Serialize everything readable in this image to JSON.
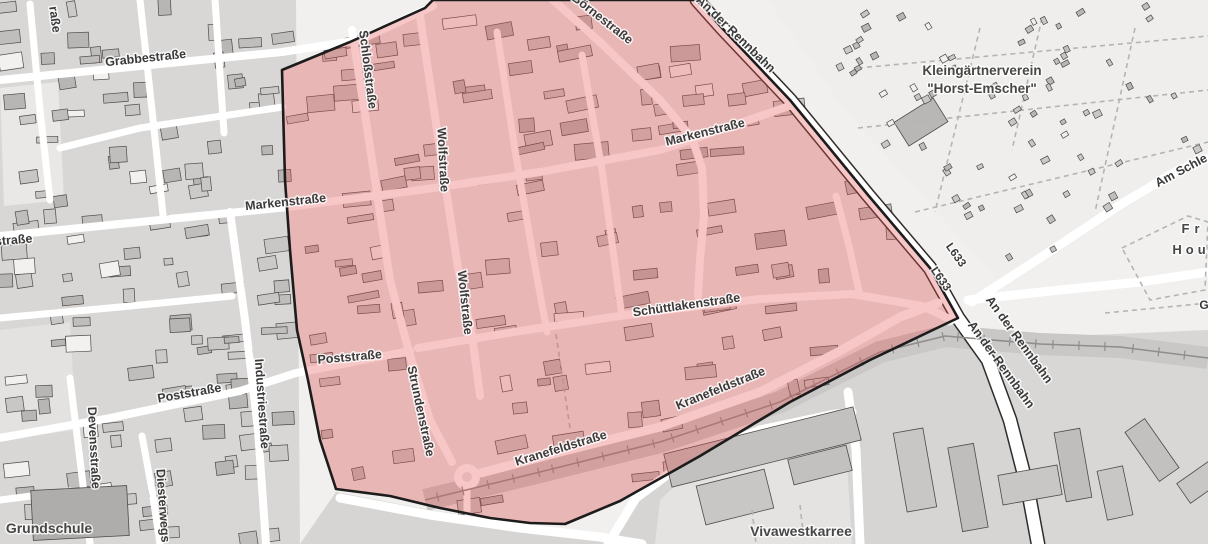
{
  "map": {
    "colors": {
      "background": "#f1f0ee",
      "block_gray": "#d8d7d5",
      "block_light": "#e9e8e6",
      "kgv_bg": "#efeeec",
      "street_white": "#ffffff",
      "building_outline": "#4e4a48",
      "main_road_casing": "#2e2d2c",
      "railway": "#8e8d8b",
      "railway_corridor": "#c9c8c6",
      "label_street": "#3a3a3a",
      "label_area": "#474747",
      "highlight_fill": "rgba(230,78,78,0.32)",
      "highlight_border": "#1c1c1c"
    },
    "highlight_area": {
      "points": [
        [
          282,
          70
        ],
        [
          350,
          42
        ],
        [
          425,
          8
        ],
        [
          433,
          0
        ],
        [
          697,
          0
        ],
        [
          722,
          28
        ],
        [
          790,
          100
        ],
        [
          868,
          195
        ],
        [
          930,
          268
        ],
        [
          958,
          318
        ],
        [
          870,
          360
        ],
        [
          790,
          402
        ],
        [
          700,
          456
        ],
        [
          620,
          501
        ],
        [
          565,
          524
        ],
        [
          530,
          523
        ],
        [
          490,
          518
        ],
        [
          440,
          508
        ],
        [
          390,
          496
        ],
        [
          336,
          489
        ],
        [
          320,
          440
        ],
        [
          308,
          380
        ],
        [
          297,
          330
        ],
        [
          290,
          250
        ],
        [
          285,
          180
        ]
      ]
    },
    "railway": {
      "points": [
        [
          425,
          500
        ],
        [
          540,
          472
        ],
        [
          660,
          442
        ],
        [
          780,
          402
        ],
        [
          880,
          352
        ],
        [
          945,
          336
        ],
        [
          1040,
          344
        ],
        [
          1120,
          347
        ],
        [
          1208,
          358
        ]
      ]
    },
    "roads": [
      {
        "name": "Grabbestraße",
        "width": 8,
        "points": [
          [
            0,
            80
          ],
          [
            140,
            66
          ],
          [
            282,
            52
          ],
          [
            360,
            40
          ],
          [
            433,
            6
          ]
        ]
      },
      {
        "name": "Börnestraße",
        "width": 8,
        "points": [
          [
            553,
            0
          ],
          [
            600,
            42
          ],
          [
            660,
            100
          ],
          [
            692,
            138
          ],
          [
            702,
            168
          ],
          [
            704,
            215
          ],
          [
            700,
            260
          ],
          [
            698,
            296
          ]
        ]
      },
      {
        "name": "Markenstraße",
        "width": 8,
        "points": [
          [
            0,
            236
          ],
          [
            140,
            222
          ],
          [
            288,
            207
          ],
          [
            420,
            190
          ],
          [
            540,
            172
          ],
          [
            660,
            150
          ],
          [
            694,
            139
          ],
          [
            795,
            104
          ]
        ]
      },
      {
        "name": "Schüttlakenstraße",
        "width": 8,
        "points": [
          [
            418,
            348
          ],
          [
            520,
            331
          ],
          [
            633,
            314
          ],
          [
            760,
            299
          ],
          [
            852,
            294
          ],
          [
            922,
            306
          ],
          [
            952,
            320
          ]
        ]
      },
      {
        "name": "Poststraße",
        "width": 8,
        "points": [
          [
            0,
            438
          ],
          [
            110,
            418
          ],
          [
            240,
            391
          ],
          [
            296,
            373
          ],
          [
            410,
            351
          ]
        ]
      },
      {
        "name": "Schloßstraße-Strundenstraße",
        "width": 8,
        "points": [
          [
            352,
            30
          ],
          [
            372,
            160
          ],
          [
            390,
            280
          ],
          [
            409,
            352
          ],
          [
            430,
            420
          ],
          [
            452,
            462
          ]
        ]
      },
      {
        "name": "Wolfstraße",
        "width": 8,
        "points": [
          [
            420,
            16
          ],
          [
            440,
            150
          ],
          [
            458,
            268
          ],
          [
            472,
            335
          ],
          [
            480,
            396
          ]
        ]
      },
      {
        "name": "",
        "width": 7,
        "points": [
          [
            497,
            32
          ],
          [
            515,
            150
          ],
          [
            532,
            250
          ],
          [
            547,
            332
          ]
        ]
      },
      {
        "name": "",
        "width": 7,
        "points": [
          [
            582,
            55
          ],
          [
            602,
            170
          ],
          [
            615,
            265
          ],
          [
            621,
            310
          ]
        ]
      },
      {
        "name": "",
        "width": 7,
        "points": [
          [
            836,
            196
          ],
          [
            850,
            250
          ],
          [
            860,
            296
          ]
        ]
      },
      {
        "name": "Kranefeldstraße",
        "width": 9,
        "points": [
          [
            481,
            473
          ],
          [
            560,
            452
          ],
          [
            660,
            427
          ],
          [
            760,
            392
          ],
          [
            840,
            351
          ],
          [
            900,
            317
          ],
          [
            938,
            303
          ]
        ]
      },
      {
        "name": "An der Rennbahn / L633",
        "width": 12,
        "casing": true,
        "points": [
          [
            697,
            0
          ],
          [
            722,
            28
          ],
          [
            790,
            100
          ],
          [
            868,
            195
          ],
          [
            930,
            268
          ],
          [
            958,
            318
          ],
          [
            988,
            360
          ],
          [
            1010,
            420
          ],
          [
            1028,
            490
          ],
          [
            1038,
            544
          ]
        ]
      },
      {
        "name": "Am Schle…",
        "width": 9,
        "points": [
          [
            972,
            302
          ],
          [
            1040,
            258
          ],
          [
            1120,
            205
          ],
          [
            1175,
            172
          ],
          [
            1208,
            158
          ]
        ]
      },
      {
        "name": "",
        "width": 9,
        "points": [
          [
            968,
            300
          ],
          [
            1060,
            290
          ],
          [
            1140,
            282
          ],
          [
            1208,
            272
          ]
        ]
      },
      {
        "name": "",
        "width": 9,
        "points": [
          [
            848,
            392
          ],
          [
            856,
            450
          ],
          [
            860,
            544
          ]
        ]
      },
      {
        "name": "",
        "width": 9,
        "points": [
          [
            608,
            544
          ],
          [
            636,
            498
          ],
          [
            690,
            458
          ],
          [
            760,
            430
          ],
          [
            830,
            415
          ],
          [
            852,
            412
          ]
        ]
      },
      {
        "name": "",
        "width": 9,
        "points": [
          [
            340,
            498
          ],
          [
            430,
            515
          ],
          [
            520,
            528
          ],
          [
            600,
            537
          ],
          [
            642,
            544
          ]
        ]
      },
      {
        "name": "Devensstraße",
        "width": 7,
        "points": [
          [
            70,
            378
          ],
          [
            80,
            460
          ],
          [
            90,
            544
          ]
        ]
      },
      {
        "name": "Industriestraße",
        "width": 8,
        "points": [
          [
            230,
            212
          ],
          [
            245,
            320
          ],
          [
            258,
            430
          ],
          [
            266,
            544
          ]
        ]
      },
      {
        "name": "Diesterwegstraße",
        "width": 7,
        "points": [
          [
            142,
            436
          ],
          [
            152,
            490
          ],
          [
            160,
            544
          ]
        ]
      },
      {
        "name": "teweg",
        "width": 7,
        "points": [
          [
            0,
            500
          ],
          [
            70,
            491
          ]
        ]
      },
      {
        "name": "",
        "width": 7,
        "points": [
          [
            0,
            318
          ],
          [
            120,
            307
          ],
          [
            232,
            296
          ]
        ]
      },
      {
        "name": "",
        "width": 7,
        "points": [
          [
            60,
            148
          ],
          [
            140,
            128
          ],
          [
            283,
            107
          ]
        ]
      },
      {
        "name": "",
        "width": 7,
        "points": [
          [
            30,
            4
          ],
          [
            40,
            110
          ],
          [
            50,
            200
          ]
        ]
      },
      {
        "name": "",
        "width": 7,
        "points": [
          [
            140,
            0
          ],
          [
            152,
            110
          ],
          [
            163,
            215
          ]
        ]
      },
      {
        "name": "",
        "width": 7,
        "points": [
          [
            215,
            0
          ],
          [
            224,
            133
          ]
        ]
      },
      {
        "name": "",
        "width": 7,
        "points": [
          [
            467,
            490
          ],
          [
            467,
            512
          ]
        ]
      }
    ],
    "footpaths": [
      {
        "points": [
          [
            858,
            68
          ],
          [
            1208,
            36
          ]
        ]
      },
      {
        "points": [
          [
            858,
            128
          ],
          [
            1208,
            90
          ]
        ]
      },
      {
        "points": [
          [
            915,
            212
          ],
          [
            1208,
            142
          ]
        ]
      },
      {
        "points": [
          [
            980,
            28
          ],
          [
            935,
            212
          ]
        ]
      },
      {
        "points": [
          [
            1135,
            28
          ],
          [
            1095,
            212
          ]
        ]
      },
      {
        "points": [
          [
            1042,
            18
          ],
          [
            1012,
            150
          ]
        ]
      },
      {
        "points": [
          [
            1122,
            248
          ],
          [
            1188,
            216
          ],
          [
            1208,
            222
          ],
          [
            1205,
            290
          ],
          [
            1150,
            300
          ],
          [
            1122,
            248
          ]
        ]
      },
      {
        "points": [
          [
            1105,
            313
          ],
          [
            1208,
            303
          ]
        ]
      },
      {
        "points": [
          [
            556,
            334
          ],
          [
            570,
            428
          ]
        ]
      },
      {
        "points": [
          [
            752,
            510
          ],
          [
            756,
            543
          ]
        ]
      },
      {
        "points": [
          [
            800,
            505
          ],
          [
            804,
            540
          ]
        ]
      }
    ],
    "labels": [
      {
        "text": "Grabbestraße",
        "x": 146,
        "y": 62,
        "rot": -6,
        "size": 12.5,
        "kind": "street"
      },
      {
        "text": "raße",
        "x": 51,
        "y": 20,
        "rot": 82,
        "size": 12.5,
        "kind": "street"
      },
      {
        "text": "Schloßstraße",
        "x": 364,
        "y": 70,
        "rot": 83,
        "size": 12.5,
        "kind": "street"
      },
      {
        "text": "Wolfstraße",
        "x": 439,
        "y": 160,
        "rot": 87,
        "size": 12.5,
        "kind": "street"
      },
      {
        "text": "Wolfstraße",
        "x": 461,
        "y": 303,
        "rot": 84,
        "size": 12.5,
        "kind": "street"
      },
      {
        "text": "Börnestraße",
        "x": 600,
        "y": 22,
        "rot": 38,
        "size": 12.5,
        "kind": "street"
      },
      {
        "text": "Markenstraße",
        "x": 286,
        "y": 206,
        "rot": -6,
        "size": 12.5,
        "kind": "street"
      },
      {
        "text": "Markenstraße",
        "x": 706,
        "y": 136,
        "rot": -14,
        "size": 12.5,
        "kind": "street"
      },
      {
        "text": "An der Rennbahn",
        "x": 733,
        "y": 37,
        "rot": 44,
        "size": 12.5,
        "kind": "street"
      },
      {
        "text": "Kleingärtnerverein",
        "x": 982,
        "y": 75,
        "rot": 0,
        "size": 13.5,
        "kind": "area"
      },
      {
        "text": "\"Horst-Emscher\"",
        "x": 982,
        "y": 93,
        "rot": 0,
        "size": 13.5,
        "kind": "area"
      },
      {
        "text": "Am Schle",
        "x": 1183,
        "y": 174,
        "rot": -28,
        "size": 12.5,
        "kind": "street"
      },
      {
        "text": "L633",
        "x": 953,
        "y": 257,
        "rot": 55,
        "size": 11.5,
        "kind": "street"
      },
      {
        "text": "L633",
        "x": 938,
        "y": 281,
        "rot": 55,
        "size": 11.5,
        "kind": "street"
      },
      {
        "text": "An der Rennbahn",
        "x": 1016,
        "y": 342,
        "rot": 54,
        "size": 12.5,
        "kind": "street"
      },
      {
        "text": "An der Rennbahn",
        "x": 998,
        "y": 367,
        "rot": 54,
        "size": 12.5,
        "kind": "street"
      },
      {
        "text": "Fr",
        "x": 1193,
        "y": 233,
        "rot": 0,
        "size": 13,
        "ls": 5,
        "kind": "area"
      },
      {
        "text": "Hou",
        "x": 1191,
        "y": 254,
        "rot": 0,
        "size": 13,
        "ls": 4,
        "kind": "area"
      },
      {
        "text": "G",
        "x": 1204,
        "y": 309,
        "rot": 0,
        "size": 12,
        "kind": "street"
      },
      {
        "text": "Schüttlakenstraße",
        "x": 687,
        "y": 309,
        "rot": -8,
        "size": 12.5,
        "kind": "street"
      },
      {
        "text": "straße",
        "x": 14,
        "y": 244,
        "rot": -5,
        "size": 12.5,
        "kind": "street"
      },
      {
        "text": "Poststraße",
        "x": 190,
        "y": 397,
        "rot": -10,
        "size": 12.5,
        "kind": "street"
      },
      {
        "text": "Poststraße",
        "x": 350,
        "y": 361,
        "rot": -5,
        "size": 12.5,
        "kind": "street"
      },
      {
        "text": "Industriestraße",
        "x": 258,
        "y": 404,
        "rot": 86,
        "size": 12.5,
        "kind": "street"
      },
      {
        "text": "Devensstraße",
        "x": 90,
        "y": 448,
        "rot": 87,
        "size": 12.5,
        "kind": "street"
      },
      {
        "text": "Diesterwegs",
        "x": 159,
        "y": 506,
        "rot": 86,
        "size": 12.5,
        "kind": "street"
      },
      {
        "text": "Strundenstraße",
        "x": 417,
        "y": 412,
        "rot": 78,
        "size": 12.5,
        "kind": "street"
      },
      {
        "text": "Kranefeldstraße",
        "x": 562,
        "y": 452,
        "rot": -17,
        "size": 12.5,
        "kind": "street"
      },
      {
        "text": "Kranefeldstraße",
        "x": 722,
        "y": 392,
        "rot": -22,
        "size": 12.5,
        "kind": "street"
      },
      {
        "text": "Vivawestkarree",
        "x": 801,
        "y": 536,
        "rot": 0,
        "size": 14,
        "kind": "area"
      },
      {
        "text": "Grundschule",
        "x": 49,
        "y": 533,
        "rot": 0,
        "size": 14,
        "kind": "area"
      }
    ]
  }
}
